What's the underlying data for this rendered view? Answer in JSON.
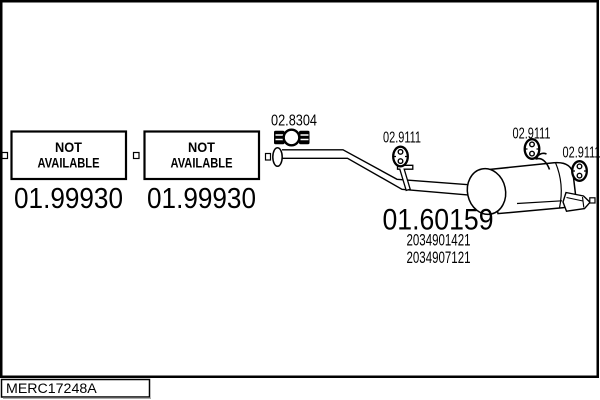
{
  "colors": {
    "ink": "#000000",
    "paper": "#ffffff"
  },
  "footer": {
    "code": "MERC17248A"
  },
  "not_available_boxes": [
    {
      "line1": "NOT",
      "line2": "AVAILABLE",
      "part_number": "01.99930"
    },
    {
      "line1": "NOT",
      "line2": "AVAILABLE",
      "part_number": "01.99930"
    }
  ],
  "parts": {
    "clamp": {
      "part_number": "02.8304"
    },
    "front_hanger": {
      "part_number": "02.9111"
    },
    "rear_hanger_top": {
      "part_number": "02.9111"
    },
    "rear_hanger_right": {
      "part_number": "02.9111"
    },
    "rear_silencer": {
      "part_number": "01.60159",
      "oe_references": [
        "2034901421",
        "2034907121"
      ]
    }
  }
}
